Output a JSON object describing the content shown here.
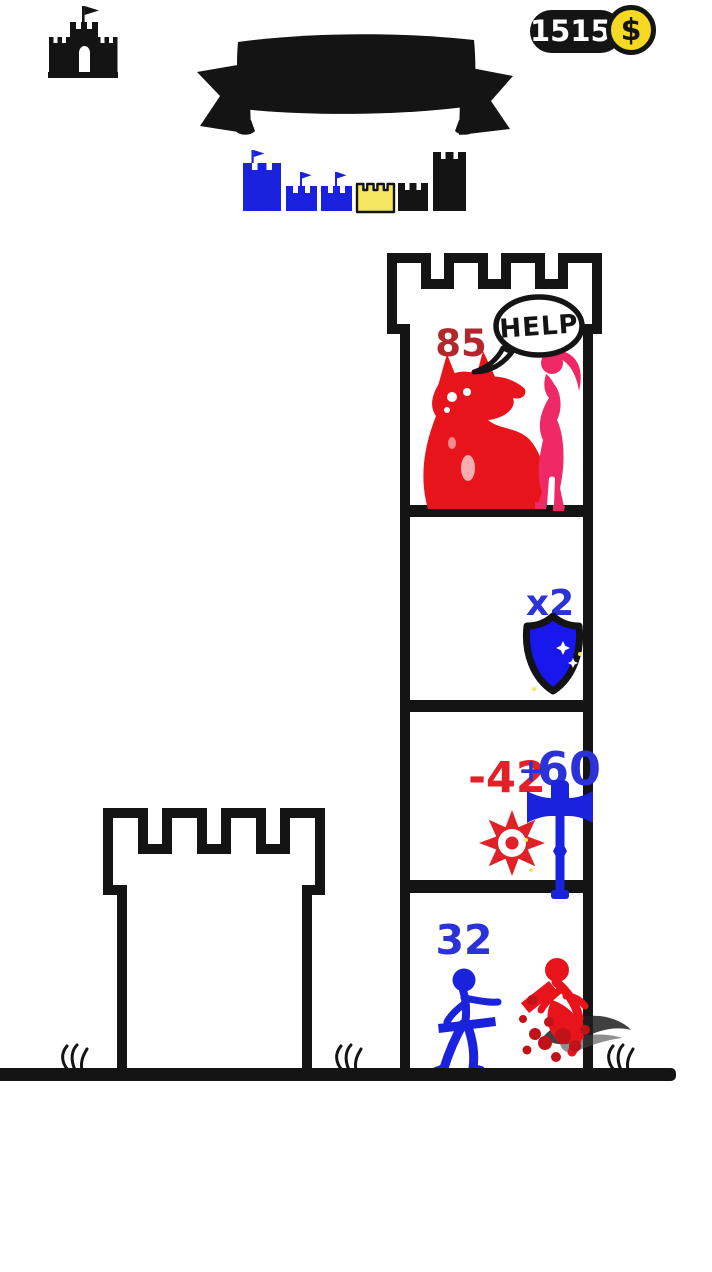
{
  "hud": {
    "castle_button": {
      "icon": "castle-icon"
    },
    "coin_counter": {
      "amount": "15150",
      "currency_symbol": "$",
      "pill_color": "#141414",
      "coin_color": "#f5d822"
    }
  },
  "banner": {
    "label": ""
  },
  "level_progress": {
    "items": [
      {
        "icon": "blue-tower-flag",
        "color": "#1b22dd",
        "state": "completed"
      },
      {
        "icon": "blue-castle-flag",
        "color": "#1b22dd",
        "state": "completed"
      },
      {
        "icon": "blue-castle-flag",
        "color": "#1b22dd",
        "state": "completed"
      },
      {
        "icon": "yellow-castle-current",
        "color": "#f5e662",
        "state": "current"
      },
      {
        "icon": "black-castle",
        "color": "#141414",
        "state": "upcoming"
      },
      {
        "icon": "black-tower",
        "color": "#141414",
        "state": "upcoming"
      }
    ]
  },
  "tower": {
    "floors": [
      {
        "id": "top-floor",
        "enemy_power": "85",
        "help_bubble": "HELP",
        "characters": [
          "red-monster",
          "pink-princess"
        ]
      },
      {
        "id": "shield-floor",
        "multiplier": "x2",
        "item": "blue-shield"
      },
      {
        "id": "weapon-floor",
        "red_value": "-42",
        "blue_sign": "+",
        "blue_value": "60",
        "items": [
          "red-saw-blade",
          "blue-hammer"
        ]
      },
      {
        "id": "hero-floor",
        "hero_power": "32",
        "characters": [
          "blue-hero",
          "red-defeated-enemy"
        ]
      }
    ]
  },
  "colors": {
    "black": "#141414",
    "figure_blue": "#1b22dd",
    "number_blue": "#2a32d8",
    "shield_blue": "#1717ee",
    "monster_red": "#e8141c",
    "number_dark_red": "#b2262c",
    "number_bright_red": "#e02127",
    "princess_pink": "#ee2966",
    "castle_yellow": "#f5e662",
    "coin_yellow": "#f5d822"
  }
}
